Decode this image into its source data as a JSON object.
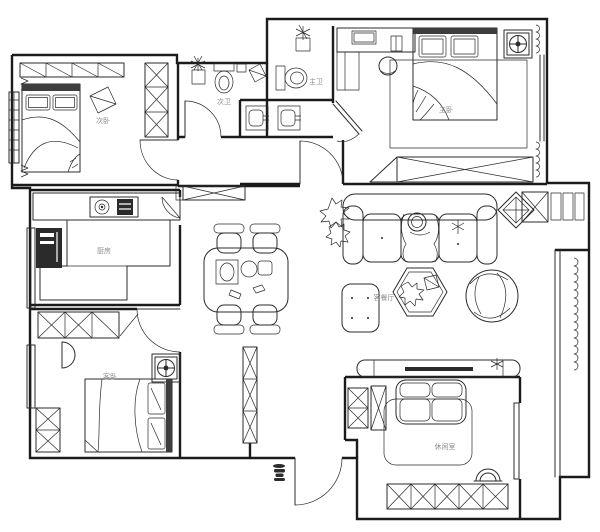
{
  "rooms": {
    "secondary_bedroom": "次卧",
    "secondary_bath": "次卫",
    "master_bath": "主卫",
    "master_bedroom": "主卧",
    "kitchen": "厨房",
    "living_dining": "客餐厅",
    "guest_bedroom": "客卧",
    "leisure_room": "休闲室"
  },
  "colors": {
    "line": "#1b1b1b",
    "label": "#8c8c8c",
    "background": "#ffffff",
    "dark_fill": "#2b2b2b"
  }
}
